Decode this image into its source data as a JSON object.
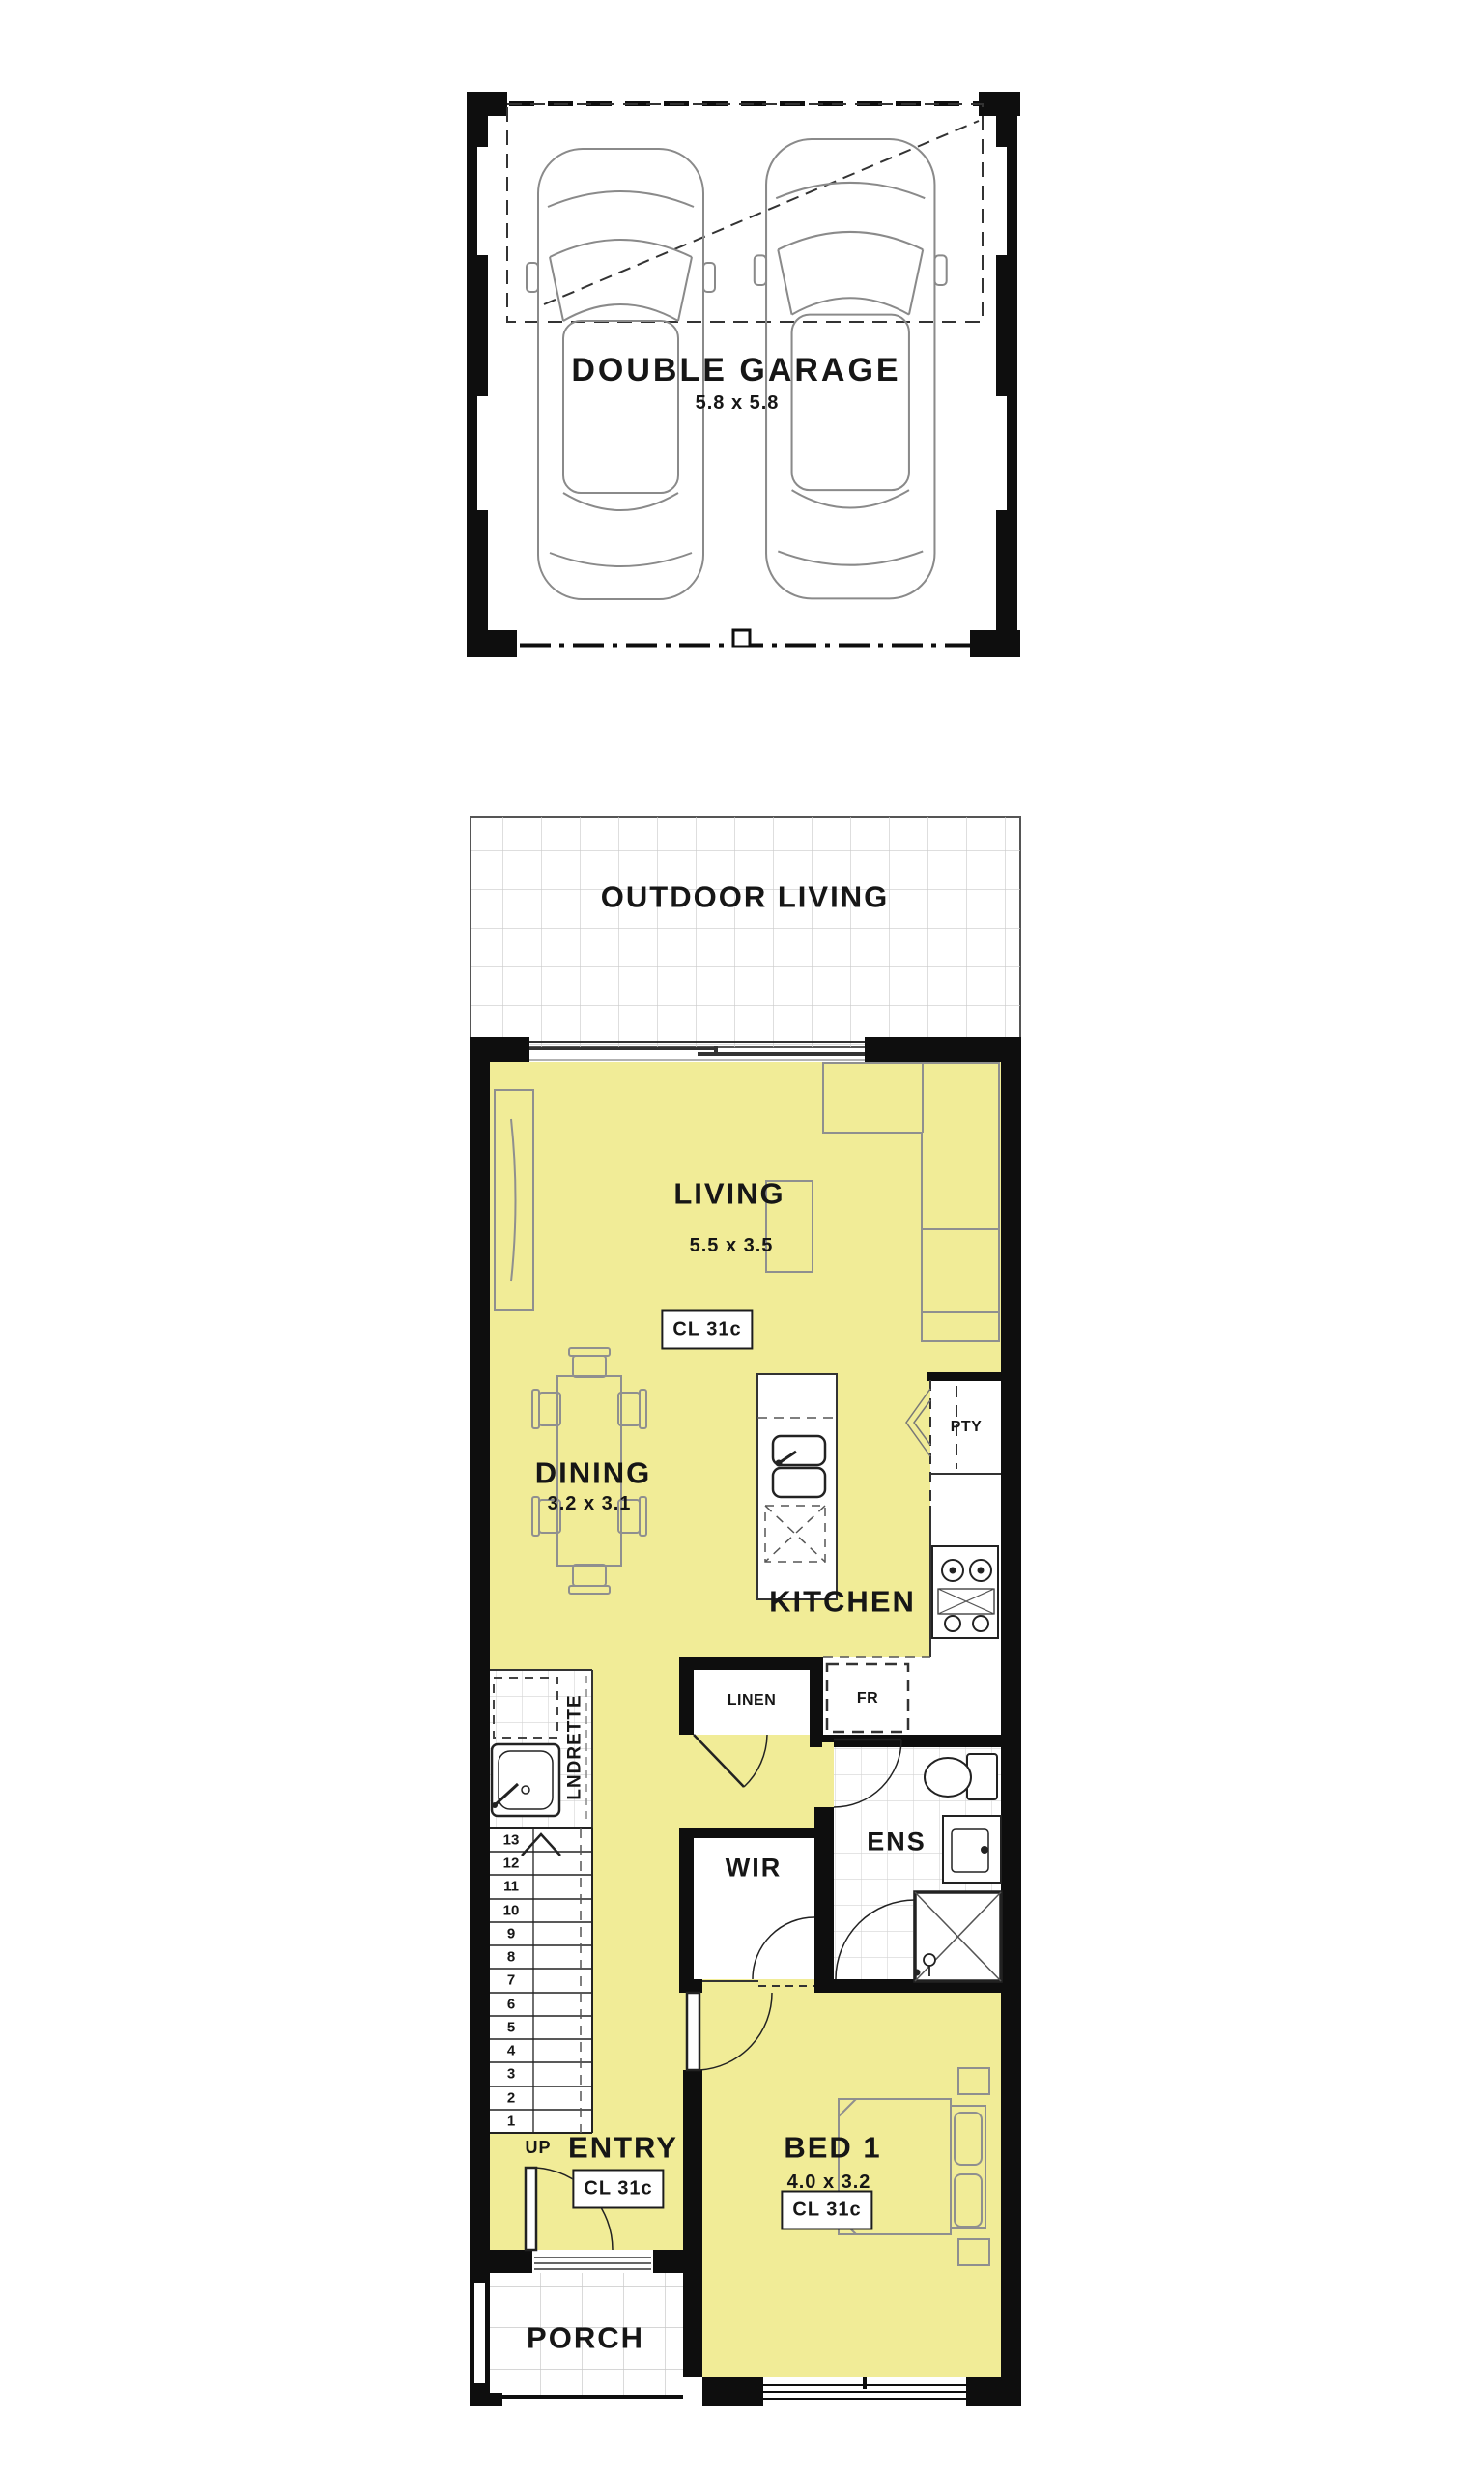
{
  "plan": {
    "garage": {
      "name": "DOUBLE GARAGE",
      "dims": "5.8 x 5.8"
    },
    "outdoor_living": {
      "name": "OUTDOOR LIVING"
    },
    "living": {
      "name": "LIVING",
      "dims": "5.5 x 3.5",
      "ceiling": "CL 31c"
    },
    "dining": {
      "name": "DINING",
      "dims": "3.2 x 3.1"
    },
    "kitchen": {
      "name": "KITCHEN",
      "pantry": "PTY",
      "fridge": "FR",
      "linen": "LINEN"
    },
    "laundry": {
      "name": "LNDRETTE"
    },
    "ensuite": {
      "name": "ENS"
    },
    "wir": {
      "name": "WIR"
    },
    "stairs": {
      "up_label": "UP",
      "numbers": [
        "13",
        "12",
        "11",
        "10",
        "9",
        "8",
        "7",
        "6",
        "5",
        "4",
        "3",
        "2",
        "1"
      ]
    },
    "entry": {
      "name": "ENTRY",
      "ceiling": "CL 31c"
    },
    "bed1": {
      "name": "BED 1",
      "dims": "4.0 x 3.2",
      "ceiling": "CL 31c"
    },
    "porch": {
      "name": "PORCH"
    }
  },
  "colors": {
    "floor_yellow": "#F1EC97",
    "wall_black": "#0E0E0E",
    "tile_line": "#CBCBCB",
    "furniture_line": "#8A8A8A",
    "text": "#161616"
  }
}
